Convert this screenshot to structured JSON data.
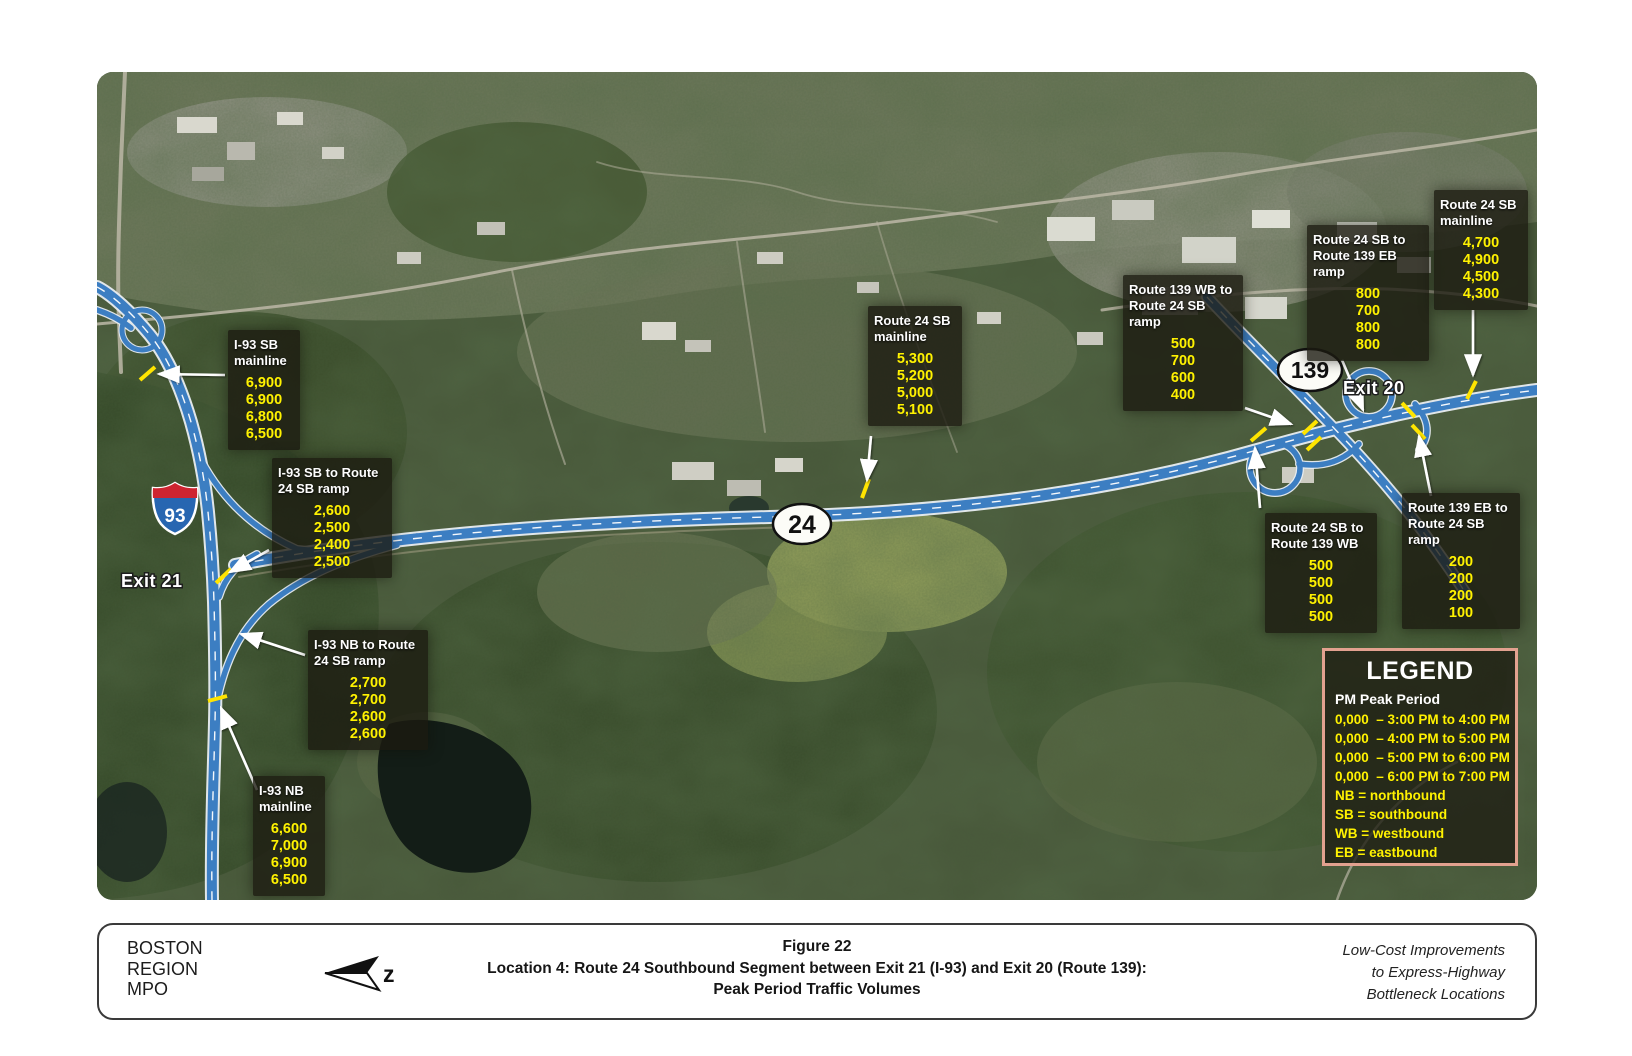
{
  "map": {
    "shields": {
      "i93": "93",
      "route24": "24",
      "route139": "139"
    },
    "exits": {
      "exit21": "Exit 21",
      "exit20": "Exit 20"
    },
    "count_boxes": [
      {
        "title": "I-93 SB mainline",
        "values": [
          "6,900",
          "6,900",
          "6,800",
          "6,500"
        ]
      },
      {
        "title": "I-93 SB to Route 24 SB ramp",
        "values": [
          "2,600",
          "2,500",
          "2,400",
          "2,500"
        ]
      },
      {
        "title": "I-93 NB to Route 24 SB ramp",
        "values": [
          "2,700",
          "2,700",
          "2,600",
          "2,600"
        ]
      },
      {
        "title": "I-93 NB mainline",
        "values": [
          "6,600",
          "7,000",
          "6,900",
          "6,500"
        ]
      },
      {
        "title": "Route 24 SB mainline",
        "values": [
          "5,300",
          "5,200",
          "5,000",
          "5,100"
        ]
      },
      {
        "title": "Route 139 WB to Route 24 SB ramp",
        "values": [
          "500",
          "700",
          "600",
          "400"
        ]
      },
      {
        "title": "Route 24 SB to Route 139 EB ramp",
        "values": [
          "800",
          "700",
          "800",
          "800"
        ]
      },
      {
        "title": "Route 24 SB mainline",
        "values": [
          "4,700",
          "4,900",
          "4,500",
          "4,300"
        ]
      },
      {
        "title": "Route 24 SB to Route 139 WB",
        "values": [
          "500",
          "500",
          "500",
          "500"
        ]
      },
      {
        "title": "Route 139 EB to Route 24 SB ramp",
        "values": [
          "200",
          "200",
          "200",
          "100"
        ]
      }
    ]
  },
  "legend": {
    "title": "LEGEND",
    "subtitle": "PM Peak Period",
    "items": [
      "0,000  – 3:00 PM to 4:00 PM",
      "0,000  – 4:00 PM to 5:00 PM",
      "0,000  – 5:00 PM to 6:00 PM",
      "0,000  – 6:00 PM to 7:00 PM",
      "NB = northbound",
      "SB = southbound",
      "WB = westbound",
      "EB = eastbound"
    ]
  },
  "footer": {
    "org": "BOSTON\nREGION\nMPO",
    "north_label": "z",
    "figure_line1": "Figure 22",
    "figure_line2": "Location 4: Route 24 Southbound Segment between Exit 21 (I-93) and Exit 20 (Route 139):",
    "figure_line3": "Peak Period Traffic Volumes",
    "project": "Low-Cost Improvements\nto Express-Highway\nBottleneck Locations"
  },
  "colors": {
    "count_text": "#fff200",
    "legend_border": "#e2a18f",
    "highway_blue": "#3c7ec2",
    "tick_yellow": "#ffe400"
  }
}
